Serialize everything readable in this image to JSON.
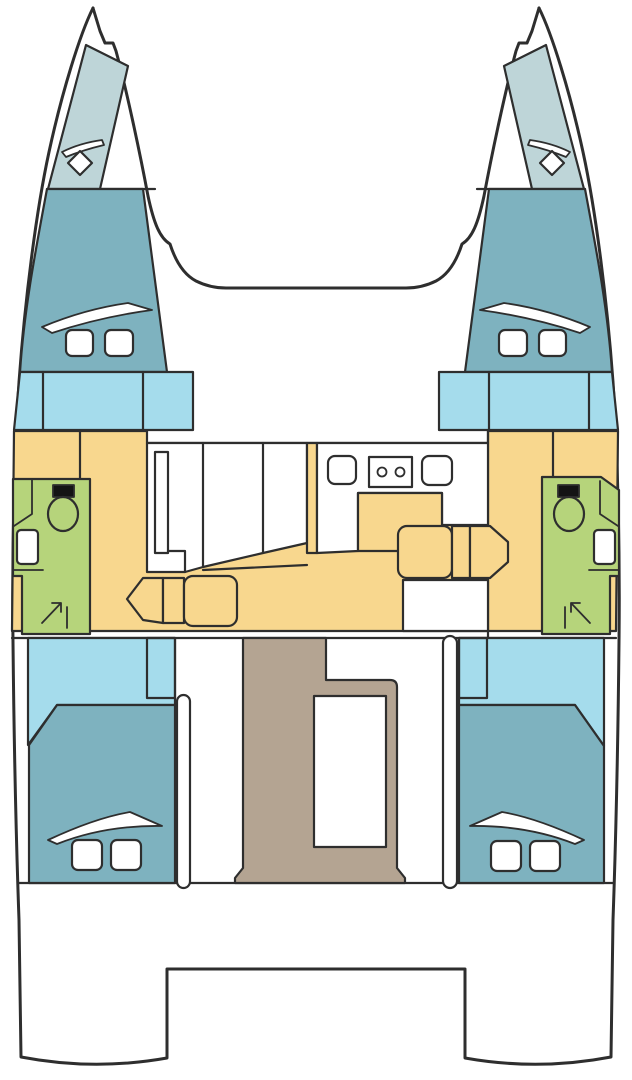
{
  "diagram": {
    "title": "Catamaran interior layout plan, top view",
    "orientation": "bow at top, stern at bottom",
    "rooms": [
      {
        "id": "port-forepeak",
        "label": "Port forepeak locker",
        "color_role": "forepeak"
      },
      {
        "id": "starboard-forepeak",
        "label": "Starboard forepeak locker",
        "color_role": "forepeak"
      },
      {
        "id": "port-forward-cabin",
        "label": "Port forward cabin",
        "color_role": "cabin"
      },
      {
        "id": "starboard-forward-cabin",
        "label": "Starboard forward cabin",
        "color_role": "cabin"
      },
      {
        "id": "port-forward-wardrobe",
        "label": "Port forward wardrobe / steps",
        "color_role": "entry"
      },
      {
        "id": "starboard-forward-wardrobe",
        "label": "Starboard forward wardrobe / steps",
        "color_role": "entry"
      },
      {
        "id": "port-head",
        "label": "Port bathroom with shower",
        "color_role": "bathroom"
      },
      {
        "id": "starboard-head",
        "label": "Starboard bathroom with shower",
        "color_role": "bathroom"
      },
      {
        "id": "salon",
        "label": "Salon / dinette",
        "color_role": "furniture"
      },
      {
        "id": "galley",
        "label": "Galley",
        "color_role": "furniture"
      },
      {
        "id": "cockpit",
        "label": "Aft cockpit",
        "color_role": "cockpit"
      },
      {
        "id": "port-aft-cabin",
        "label": "Port aft cabin",
        "color_role": "cabin"
      },
      {
        "id": "starboard-aft-cabin",
        "label": "Starboard aft cabin",
        "color_role": "cabin"
      },
      {
        "id": "aft-deck",
        "label": "Aft deck / transom platform",
        "color_role": "hull"
      }
    ],
    "features": {
      "toilets": 2,
      "bathroom_sinks": 2,
      "shower_symbols": 2,
      "galley_sinks": 2,
      "stove_burners": 2,
      "salon_table": 1,
      "cockpit_table": 1,
      "berth_deck_hatches": 8,
      "forepeak_hatches": 2,
      "hull_windows": 6,
      "sliding_doors": 2
    },
    "palette": {
      "outline": "#2e2e2e",
      "hull": "#ffffff",
      "forepeak": "#bed5d8",
      "cabin": "#7eb2bf",
      "entry": "#a5dcec",
      "furniture": "#f8d78e",
      "bathroom": "#b6d47b",
      "cockpit": "#b4a492",
      "white": "#ffffff",
      "tank": "#141414"
    }
  }
}
